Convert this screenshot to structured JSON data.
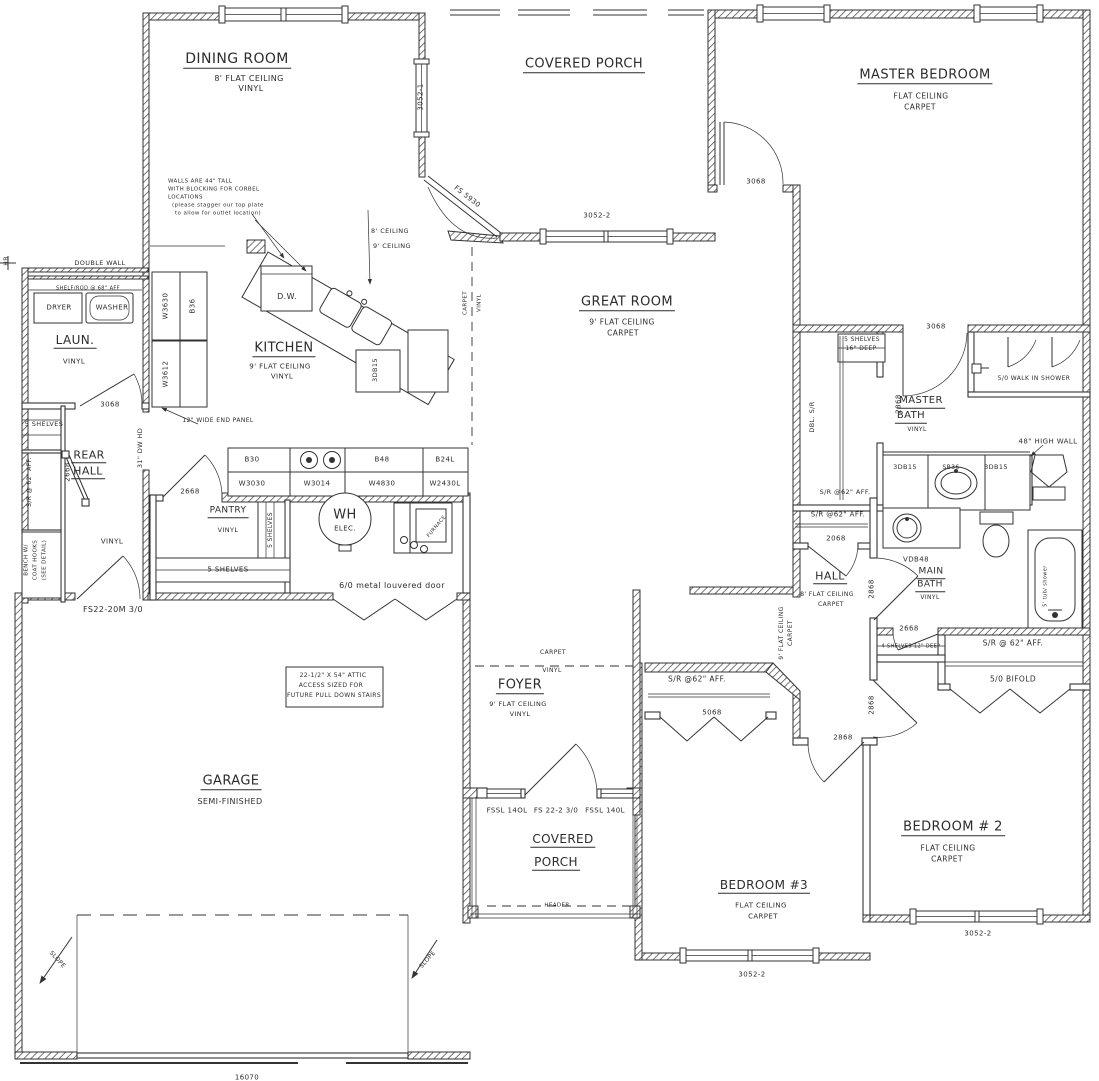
{
  "document": {
    "type": "residential floor plan",
    "background": "#ffffff",
    "line_color": "#2c2c2c"
  },
  "labels": {
    "rooms": [
      {
        "n": "room-dining-room",
        "t": "DINING ROOM",
        "x": 237,
        "y": 60,
        "s": 14,
        "u": 1
      },
      {
        "t": "8' FLAT CEILING",
        "x": 249,
        "y": 79,
        "s": 8
      },
      {
        "t": "VINYL",
        "x": 251,
        "y": 89,
        "s": 8
      },
      {
        "n": "room-covered-porch-top",
        "t": "COVERED PORCH",
        "x": 584,
        "y": 65,
        "s": 13,
        "u": 1
      },
      {
        "n": "room-master-bedroom",
        "t": "MASTER BEDROOM",
        "x": 925,
        "y": 76,
        "s": 13,
        "u": 1
      },
      {
        "t": "FLAT CEILING",
        "x": 921,
        "y": 96,
        "s": 7.5
      },
      {
        "t": "CARPET",
        "x": 920,
        "y": 107,
        "s": 7.5
      },
      {
        "n": "room-great-room",
        "t": "GREAT ROOM",
        "x": 627,
        "y": 303,
        "s": 13,
        "u": 1
      },
      {
        "t": "9' FLAT CEILING",
        "x": 622,
        "y": 322,
        "s": 7.5
      },
      {
        "t": "CARPET",
        "x": 623,
        "y": 333,
        "s": 7.5
      },
      {
        "n": "room-kitchen",
        "t": "KITCHEN",
        "x": 284,
        "y": 349,
        "s": 13,
        "u": 1
      },
      {
        "t": "9' FLAT CEILING",
        "x": 280,
        "y": 367,
        "s": 7
      },
      {
        "t": "VINYL",
        "x": 282,
        "y": 377,
        "s": 7
      },
      {
        "n": "room-laundry",
        "t": "LAUN.",
        "x": 75,
        "y": 341,
        "s": 12,
        "u": 1
      },
      {
        "t": "VINYL",
        "x": 74,
        "y": 362,
        "s": 7
      },
      {
        "n": "room-rear-hall",
        "t": "REAR",
        "x": 89,
        "y": 456,
        "s": 11,
        "u": 1
      },
      {
        "n": "room-rear-hall-2",
        "t": "HALL",
        "x": 88,
        "y": 472,
        "s": 11,
        "u": 1
      },
      {
        "t": "VINYL",
        "x": 112,
        "y": 542,
        "s": 7
      },
      {
        "n": "room-pantry",
        "t": "PANTRY",
        "x": 228,
        "y": 512,
        "s": 9,
        "u": 1
      },
      {
        "t": "VINYL",
        "x": 228,
        "y": 530,
        "s": 6.5
      },
      {
        "n": "room-foyer",
        "t": "FOYER",
        "x": 520,
        "y": 686,
        "s": 13,
        "u": 1
      },
      {
        "t": "9' FLAT CEILING",
        "x": 518,
        "y": 704,
        "s": 6.5
      },
      {
        "t": "VINYL",
        "x": 520,
        "y": 714,
        "s": 6.5
      },
      {
        "n": "room-garage",
        "t": "GARAGE",
        "x": 231,
        "y": 782,
        "s": 13,
        "u": 1
      },
      {
        "t": "SEMI-FINISHED",
        "x": 230,
        "y": 802,
        "s": 8
      },
      {
        "n": "room-covered-porch-bottom",
        "t": "COVERED",
        "x": 563,
        "y": 840,
        "s": 12,
        "u": 1
      },
      {
        "n": "room-covered-porch-bottom-2",
        "t": "PORCH",
        "x": 556,
        "y": 863,
        "s": 12,
        "u": 1
      },
      {
        "n": "room-hall",
        "t": "HALL",
        "x": 830,
        "y": 577,
        "s": 11,
        "u": 1
      },
      {
        "t": "8' FLAT CEILING",
        "x": 827,
        "y": 595,
        "s": 6
      },
      {
        "t": "CARPET",
        "x": 831,
        "y": 605,
        "s": 6
      },
      {
        "n": "room-master-bath",
        "t": "MASTER",
        "x": 921,
        "y": 402,
        "s": 10,
        "u": 1
      },
      {
        "n": "room-master-bath-2",
        "t": "BATH",
        "x": 911,
        "y": 417,
        "s": 10,
        "u": 1
      },
      {
        "t": "VINYL",
        "x": 917,
        "y": 430,
        "s": 6
      },
      {
        "n": "room-main-bath",
        "t": "MAIN",
        "x": 931,
        "y": 573,
        "s": 9,
        "u": 1
      },
      {
        "n": "room-main-bath-2",
        "t": "BATH",
        "x": 930,
        "y": 586,
        "s": 9,
        "u": 1
      },
      {
        "t": "VINYL",
        "x": 930,
        "y": 598,
        "s": 6
      },
      {
        "n": "room-bedroom-3",
        "t": "BEDROOM #3",
        "x": 764,
        "y": 886,
        "s": 12,
        "u": 1
      },
      {
        "t": "FLAT CEILING",
        "x": 761,
        "y": 906,
        "s": 7
      },
      {
        "t": "CARPET",
        "x": 763,
        "y": 917,
        "s": 7
      },
      {
        "n": "room-bedroom-2",
        "t": "BEDROOM # 2",
        "x": 953,
        "y": 828,
        "s": 13,
        "u": 1
      },
      {
        "t": "FLAT CEILING",
        "x": 948,
        "y": 848,
        "s": 7.5
      },
      {
        "t": "CARPET",
        "x": 947,
        "y": 859,
        "s": 7.5
      },
      {
        "n": "hall-ceiling-note",
        "t": "9' FLAT CEILING",
        "x": 782,
        "y": 633,
        "s": 6,
        "r": -90
      },
      {
        "t": "CARPET",
        "x": 791,
        "y": 633,
        "s": 6,
        "r": -90
      }
    ],
    "doors_windows": [
      {
        "n": "window-3052-1",
        "t": "3052-1",
        "x": 421,
        "y": 97,
        "s": 7,
        "r": -90
      },
      {
        "n": "door-fs5930",
        "t": "FS 5930",
        "x": 467,
        "y": 197,
        "s": 7,
        "r": 38
      },
      {
        "n": "window-3052-2-porch",
        "t": "3052-2",
        "x": 597,
        "y": 216,
        "s": 7
      },
      {
        "n": "door-3068-porch",
        "t": "3068",
        "x": 756,
        "y": 182,
        "s": 7
      },
      {
        "n": "door-3068-laundry",
        "t": "3068",
        "x": 110,
        "y": 405,
        "s": 7
      },
      {
        "n": "door-3068-master-bath",
        "t": "3068",
        "x": 936,
        "y": 327,
        "s": 7
      },
      {
        "n": "door-2668-rear-closet",
        "t": "2668",
        "x": 68,
        "y": 472,
        "s": 7,
        "r": -90
      },
      {
        "n": "door-2668-pantry",
        "t": "2668",
        "x": 190,
        "y": 492,
        "s": 7
      },
      {
        "n": "door-2068-hall-closet",
        "t": "2068",
        "x": 836,
        "y": 539,
        "s": 7
      },
      {
        "n": "door-2868-main-bath",
        "t": "2868",
        "x": 899,
        "y": 404,
        "s": 7,
        "r": -90
      },
      {
        "n": "door-2868-hall-a",
        "t": "2868",
        "x": 872,
        "y": 589,
        "s": 7,
        "r": -90
      },
      {
        "n": "door-2868-bedroom-2",
        "t": "2868",
        "x": 872,
        "y": 705,
        "s": 7,
        "r": -90
      },
      {
        "n": "door-2868-bedroom-3",
        "t": "2868",
        "x": 843,
        "y": 738,
        "s": 7
      },
      {
        "n": "door-2668-linen",
        "t": "2668",
        "x": 909,
        "y": 629,
        "s": 7
      },
      {
        "n": "door-5068-bifold",
        "t": "5068",
        "x": 712,
        "y": 713,
        "s": 7
      },
      {
        "n": "door-50-bifold",
        "t": "5/0 BIFOLD",
        "x": 1013,
        "y": 679,
        "s": 7.5
      },
      {
        "n": "door-louvered",
        "t": "6/0 metal louvered door",
        "x": 392,
        "y": 586,
        "s": 8
      },
      {
        "n": "door-fs22-garage",
        "t": "FS22-20M 3/0",
        "x": 113,
        "y": 610,
        "s": 8
      },
      {
        "n": "sidelite-left",
        "t": "FSSL 14OL",
        "x": 507,
        "y": 811,
        "s": 7
      },
      {
        "n": "front-door",
        "t": "FS 22-2 3/0",
        "x": 556,
        "y": 811,
        "s": 7
      },
      {
        "n": "sidelite-right",
        "t": "FSSL 140L",
        "x": 605,
        "y": 811,
        "s": 7
      },
      {
        "n": "window-bed3",
        "t": "3052-2",
        "x": 752,
        "y": 975,
        "s": 7
      },
      {
        "n": "window-bed2",
        "t": "3052-2",
        "x": 978,
        "y": 934,
        "s": 7
      },
      {
        "n": "garage-door-size",
        "t": "16070",
        "x": 247,
        "y": 1078,
        "s": 7
      }
    ],
    "closets": [
      {
        "n": "note-double-wall",
        "t": "DOUBLE WALL",
        "x": 100,
        "y": 263,
        "s": 6.5
      },
      {
        "n": "note-shelf-rod",
        "t": "SHELF/ROD @ 68\" AFF",
        "x": 88,
        "y": 289,
        "s": 5
      },
      {
        "n": "fixture-dryer",
        "t": "DRYER",
        "x": 59,
        "y": 308,
        "s": 7
      },
      {
        "n": "fixture-washer",
        "t": "WASHER",
        "x": 112,
        "y": 308,
        "s": 7
      },
      {
        "t": "5 SHELVES",
        "x": 44,
        "y": 424,
        "s": 6.5
      },
      {
        "t": "S/R @ 62\" AFF.",
        "x": 30,
        "y": 482,
        "s": 6,
        "r": -90
      },
      {
        "t": "BENCH W/",
        "x": 27,
        "y": 560,
        "s": 5.5,
        "r": -90
      },
      {
        "t": "COAT HOOKS",
        "x": 36,
        "y": 560,
        "s": 5.5,
        "r": -90
      },
      {
        "t": "(SEE DETAIL)",
        "x": 45,
        "y": 560,
        "s": 5.5,
        "r": -90
      },
      {
        "n": "note-dw-header",
        "t": "31\" DW HD",
        "x": 140,
        "y": 448,
        "s": 6.5,
        "r": -90
      },
      {
        "n": "note-end-panel",
        "t": "12\" WIDE END PANEL",
        "x": 218,
        "y": 421,
        "s": 6
      },
      {
        "t": "5 SHELVES",
        "x": 271,
        "y": 530,
        "s": 6,
        "r": -90
      },
      {
        "t": "5 SHELVES",
        "x": 228,
        "y": 570,
        "s": 7
      },
      {
        "t": "5 SHELVES",
        "x": 862,
        "y": 340,
        "s": 6
      },
      {
        "t": "16\" DEEP",
        "x": 861,
        "y": 349,
        "s": 6
      },
      {
        "t": "DBL. S/R",
        "x": 812,
        "y": 417,
        "s": 6.5,
        "r": -90
      },
      {
        "t": "S/R @62\" AFF.",
        "x": 845,
        "y": 492,
        "s": 6.5
      },
      {
        "t": "S/R @62\" AFF.",
        "x": 838,
        "y": 515,
        "s": 7
      },
      {
        "t": "S/R @62\" AFF.",
        "x": 697,
        "y": 679,
        "s": 7.5
      },
      {
        "t": "S/R @ 62\" AFF.",
        "x": 1013,
        "y": 643,
        "s": 7.5
      },
      {
        "t": "4 SHELVES 12\" DEEP",
        "x": 911,
        "y": 647,
        "s": 5
      },
      {
        "n": "note-walk-in-shower",
        "t": "5/0 WALK IN SHOWER",
        "x": 1034,
        "y": 379,
        "s": 6
      },
      {
        "n": "note-high-wall",
        "t": "48\" HIGH WALL",
        "x": 1048,
        "y": 442,
        "s": 7
      },
      {
        "n": "note-tub",
        "t": "5' tub/ shower",
        "x": 1046,
        "y": 586,
        "s": 5,
        "r": -90
      },
      {
        "n": "note-hose-bib",
        "t": "HB",
        "x": 7,
        "y": 261,
        "s": 6,
        "r": -90
      }
    ],
    "cabinets": [
      {
        "t": "W3630",
        "x": 166,
        "y": 306,
        "s": 7,
        "r": -90
      },
      {
        "t": "B36",
        "x": 193,
        "y": 306,
        "s": 7,
        "r": -90
      },
      {
        "t": "W3612",
        "x": 166,
        "y": 374,
        "s": 7,
        "r": -90
      },
      {
        "n": "fixture-dishwasher",
        "t": "D.W.",
        "x": 287,
        "y": 297,
        "s": 8
      },
      {
        "t": "3DB15",
        "x": 375,
        "y": 370,
        "s": 6.5,
        "r": -90
      },
      {
        "t": "B30",
        "x": 252,
        "y": 460,
        "s": 7
      },
      {
        "t": "W3030",
        "x": 252,
        "y": 484,
        "s": 7
      },
      {
        "t": "W3014",
        "x": 317,
        "y": 484,
        "s": 7
      },
      {
        "t": "B48",
        "x": 382,
        "y": 460,
        "s": 7
      },
      {
        "t": "W4830",
        "x": 382,
        "y": 484,
        "s": 7
      },
      {
        "t": "B24L",
        "x": 445,
        "y": 460,
        "s": 7
      },
      {
        "t": "W2430L",
        "x": 445,
        "y": 484,
        "s": 7
      },
      {
        "n": "fixture-water-heater",
        "t": "WH",
        "x": 345,
        "y": 515,
        "s": 13
      },
      {
        "t": "ELEC.",
        "x": 345,
        "y": 529,
        "s": 7
      },
      {
        "n": "fixture-furnace",
        "t": "FURNACE",
        "x": 437,
        "y": 527,
        "s": 5,
        "r": -50
      },
      {
        "t": "3DB15",
        "x": 905,
        "y": 467,
        "s": 6.5
      },
      {
        "t": "SB36",
        "x": 951,
        "y": 468,
        "s": 6
      },
      {
        "t": "3DB15",
        "x": 996,
        "y": 467,
        "s": 6.5
      },
      {
        "n": "fixture-vanity-main",
        "t": "VDB48",
        "x": 916,
        "y": 560,
        "s": 7
      }
    ],
    "annotations": [
      {
        "n": "note-corbel-1",
        "t": "WALLS ARE 44\" TALL",
        "x": 168,
        "y": 182,
        "s": 5.5,
        "a": "l"
      },
      {
        "n": "note-corbel-2",
        "t": "WITH BLOCKING FOR CORBEL",
        "x": 168,
        "y": 190,
        "s": 5.5,
        "a": "l"
      },
      {
        "n": "note-corbel-3",
        "t": "LOCATIONS",
        "x": 168,
        "y": 198,
        "s": 5.5,
        "a": "l"
      },
      {
        "n": "note-corbel-4",
        "t": "(please stagger our top plate",
        "x": 172,
        "y": 206,
        "s": 5.5,
        "a": "l"
      },
      {
        "n": "note-corbel-5",
        "t": "to allow for outlet location)",
        "x": 175,
        "y": 214,
        "s": 5.5,
        "a": "l"
      },
      {
        "n": "note-8-ceiling",
        "t": "8' CEILING",
        "x": 390,
        "y": 231,
        "s": 6.5
      },
      {
        "n": "note-9-ceiling",
        "t": "9' CEILING",
        "x": 392,
        "y": 246,
        "s": 6.5
      },
      {
        "n": "floor-transition-carpet",
        "t": "CARPET",
        "x": 466,
        "y": 303,
        "s": 5.5,
        "r": -90
      },
      {
        "n": "floor-transition-vinyl",
        "t": "VINYL",
        "x": 480,
        "y": 303,
        "s": 5.5,
        "r": -90
      },
      {
        "n": "foyer-transition-carpet",
        "t": "CARPET",
        "x": 553,
        "y": 653,
        "s": 6
      },
      {
        "n": "foyer-transition-vinyl",
        "t": "VINYL",
        "x": 552,
        "y": 671,
        "s": 6
      },
      {
        "n": "note-attic-1",
        "t": "22-1/2\" X 54\" ATTIC",
        "x": 333,
        "y": 676,
        "s": 6
      },
      {
        "n": "note-attic-2",
        "t": "ACCESS SIZED FOR",
        "x": 331,
        "y": 686,
        "s": 6
      },
      {
        "n": "note-attic-3",
        "t": "FUTURE PULL DOWN STAIRS",
        "x": 334,
        "y": 696,
        "s": 6
      },
      {
        "n": "note-slope-left",
        "t": "SLOPE",
        "x": 57,
        "y": 960,
        "s": 6,
        "r": 48
      },
      {
        "n": "note-slope-right",
        "t": "SLOPE",
        "x": 428,
        "y": 960,
        "s": 6,
        "r": -48
      },
      {
        "n": "note-header",
        "t": "HEADER",
        "x": 557,
        "y": 906,
        "s": 5.5
      }
    ]
  }
}
